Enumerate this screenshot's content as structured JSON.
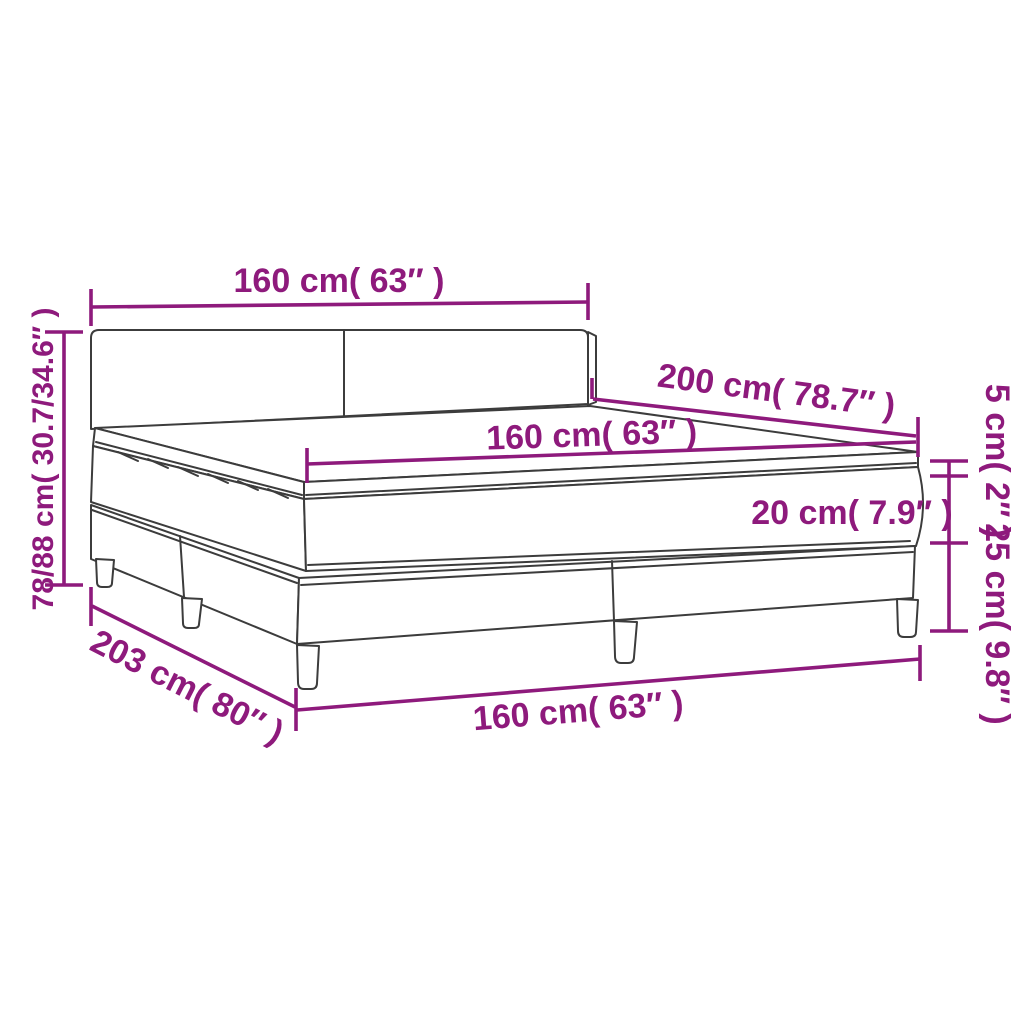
{
  "diagram": {
    "product": "box spring bed with mattress and topper",
    "colors": {
      "accent": "#8e1a7c",
      "line": "#3c3c3c",
      "background": "#ffffff"
    },
    "labels": {
      "headboard_width": "160 cm( 63″ )",
      "headboard_height": "78/88 cm( 30.7/34.6″ )",
      "bed_length": "200 cm( 78.7″ )",
      "mattress_width": "160 cm( 63″ )",
      "mattress_height": "20 cm( 7.9″ )",
      "topper_height": "5 cm( 2″ )",
      "base_height": "25 cm( 9.8″ )",
      "base_length": "203 cm( 80″ )",
      "base_width": "160 cm( 63″ )"
    }
  }
}
